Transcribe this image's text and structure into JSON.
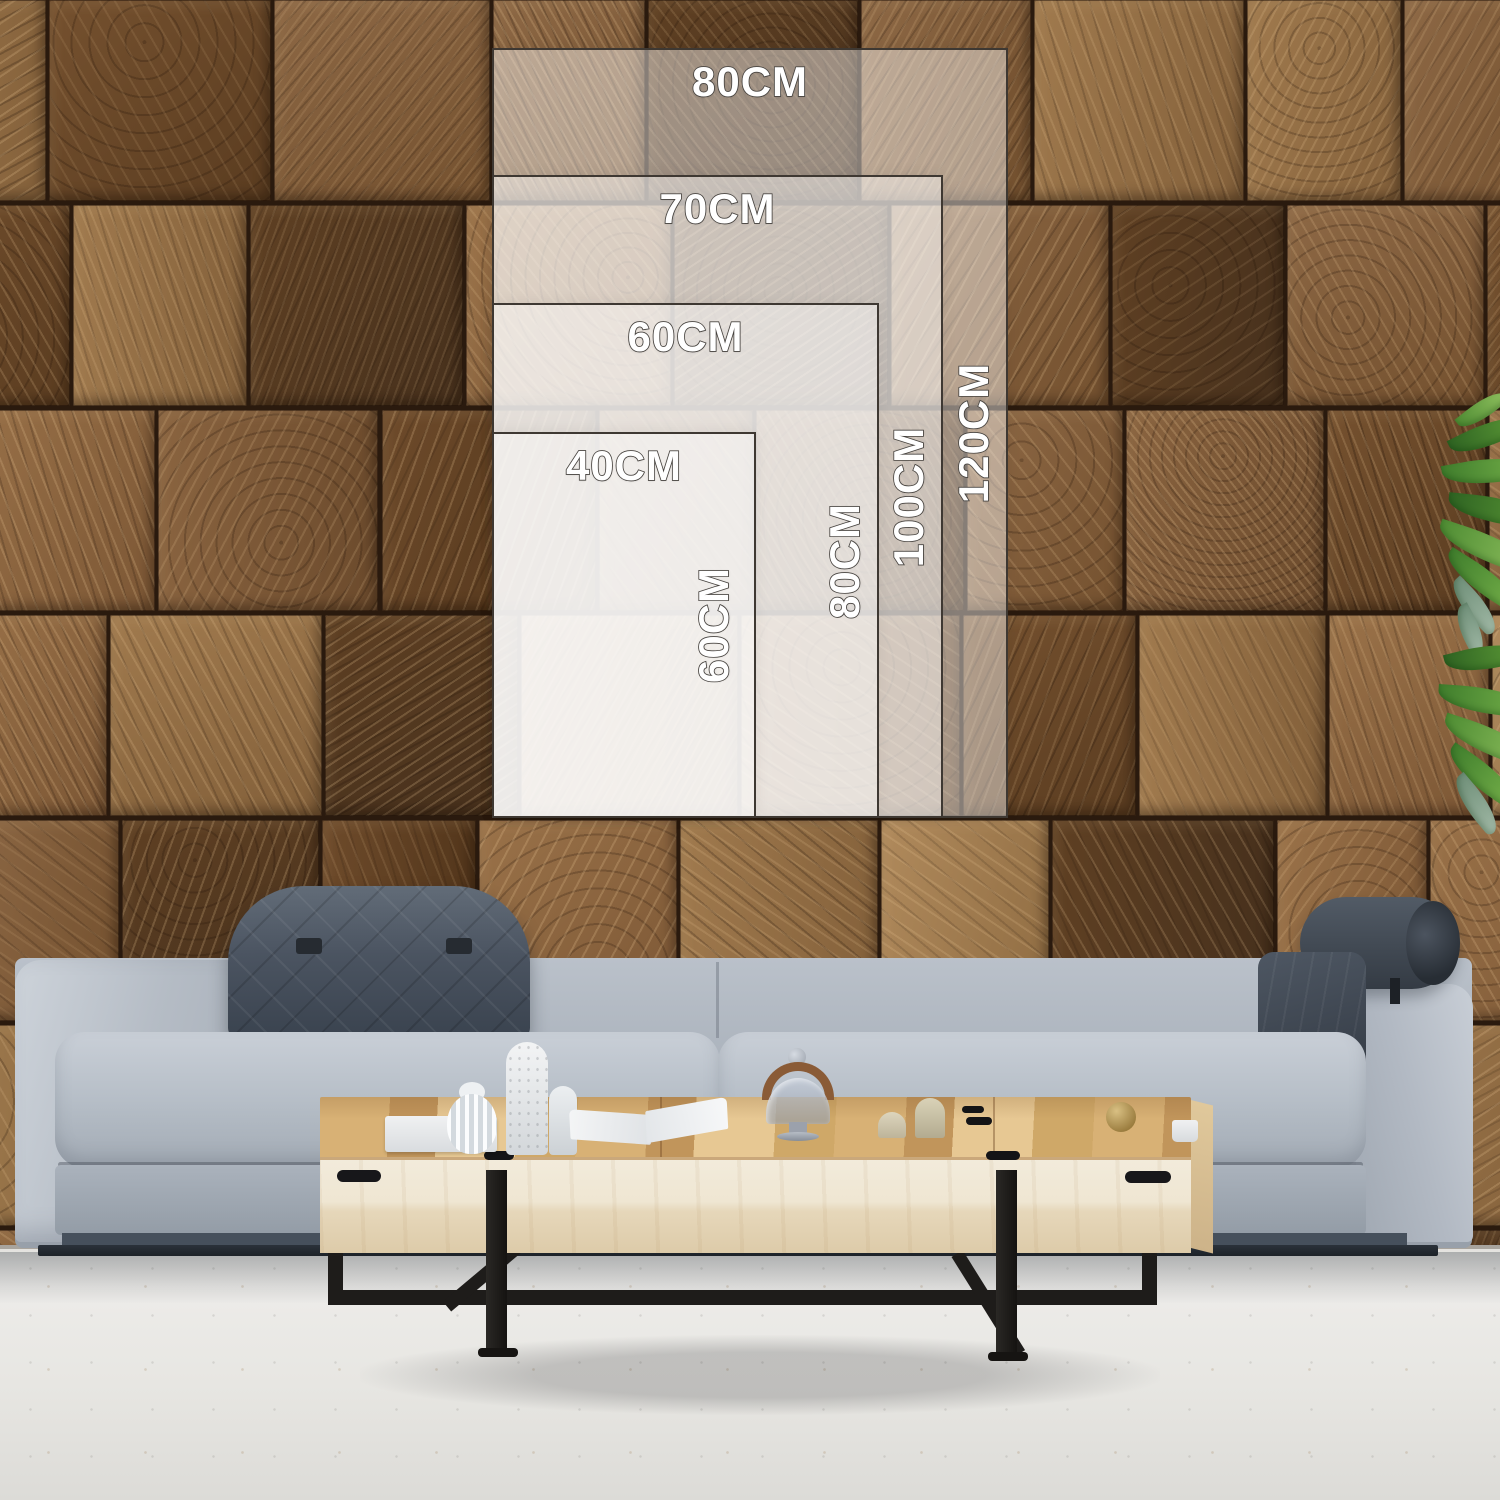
{
  "size_chart": {
    "unit": "CM",
    "options": [
      {
        "name": "80x120",
        "width_label": "80CM",
        "height_label": "120CM"
      },
      {
        "name": "70x100",
        "width_label": "70CM",
        "height_label": "100CM"
      },
      {
        "name": "60x80",
        "width_label": "60CM",
        "height_label": "80CM"
      },
      {
        "name": "40x60",
        "width_label": "40CM",
        "height_label": "60CM"
      }
    ]
  },
  "scene": {
    "objects": [
      "end-grain-wood-tile-wall",
      "gray-fabric-sofa",
      "quilted-headrest-cushion",
      "leather-roll-pillow",
      "lumbar-pillow",
      "maple-coffee-table",
      "black-metal-sled-legs",
      "white-gourd-vase",
      "white-bottle-vases",
      "open-book",
      "glass-cloche",
      "dome-candles",
      "brass-ball",
      "white-cup",
      "plant-leaves",
      "concrete-floor"
    ],
    "colors": {
      "wall_brown": "#7a573a",
      "wall_gap": "#2a1a0e",
      "sofa_gray": "#b2bac4",
      "sofa_dark": "#47515d",
      "table_wood": "#d8b175",
      "table_face": "#efe6d2",
      "metal_black": "#1e1c1a",
      "floor_light": "#e8e7e3",
      "overlay_border": "#3e3832",
      "label_fill": "#ffffff",
      "label_outline": "#4a4642",
      "plant_green": "#4e8c33"
    }
  }
}
